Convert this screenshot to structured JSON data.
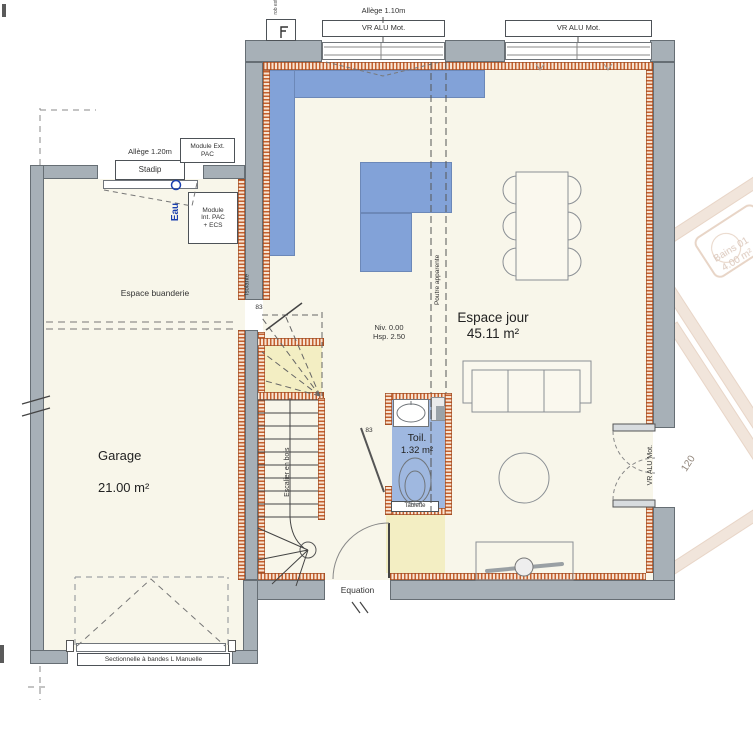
{
  "labels": {
    "allege_top": "Allège 1.10m",
    "vr_alu": "VR ALU Mot.",
    "rob_ext": "rob ext",
    "allege_left": "Allège 1.20m",
    "stadip": "Stadip",
    "module_ext_l1": "Module Ext.",
    "module_ext_l2": "PAC",
    "module_int_l1": "Module",
    "module_int_l2": "Int. PAC",
    "module_int_l3": "+ ECS",
    "eau": "Eau",
    "espace_buanderie": "Espace buanderie",
    "isolante": "Isolante",
    "door_width": "83",
    "niveau": "Niv. 0.00",
    "hauteur": "Hsp. 2.50",
    "poutre": "Poutre apparente",
    "espace_jour": "Espace jour",
    "espace_jour_area": "45.11 m²",
    "toilettes": "Toil.",
    "toilettes_area": "1.32 m²",
    "tablette": "Tablette",
    "escalier": "Escalier en bois",
    "garage": "Garage",
    "garage_area": "21.00 m²",
    "equation": "Equation",
    "porte_garage": "Sectionnelle à bandes L Manuelle",
    "ghost_room": "Bains 01",
    "ghost_room_area": "4.00 m²",
    "ghost_dim": "120"
  },
  "colors": {
    "wall_gray": "#a7b0b7",
    "insulation_orange": "#c4602f",
    "kitchen_blue": "#82a2d8",
    "toilet_blue": "#9fb8e0",
    "stair_yellow": "#f3eec3",
    "interior_cream": "#f8f6ea",
    "eau_blue": "#1a3fae",
    "ghost_tan": "#ddc0a9"
  }
}
